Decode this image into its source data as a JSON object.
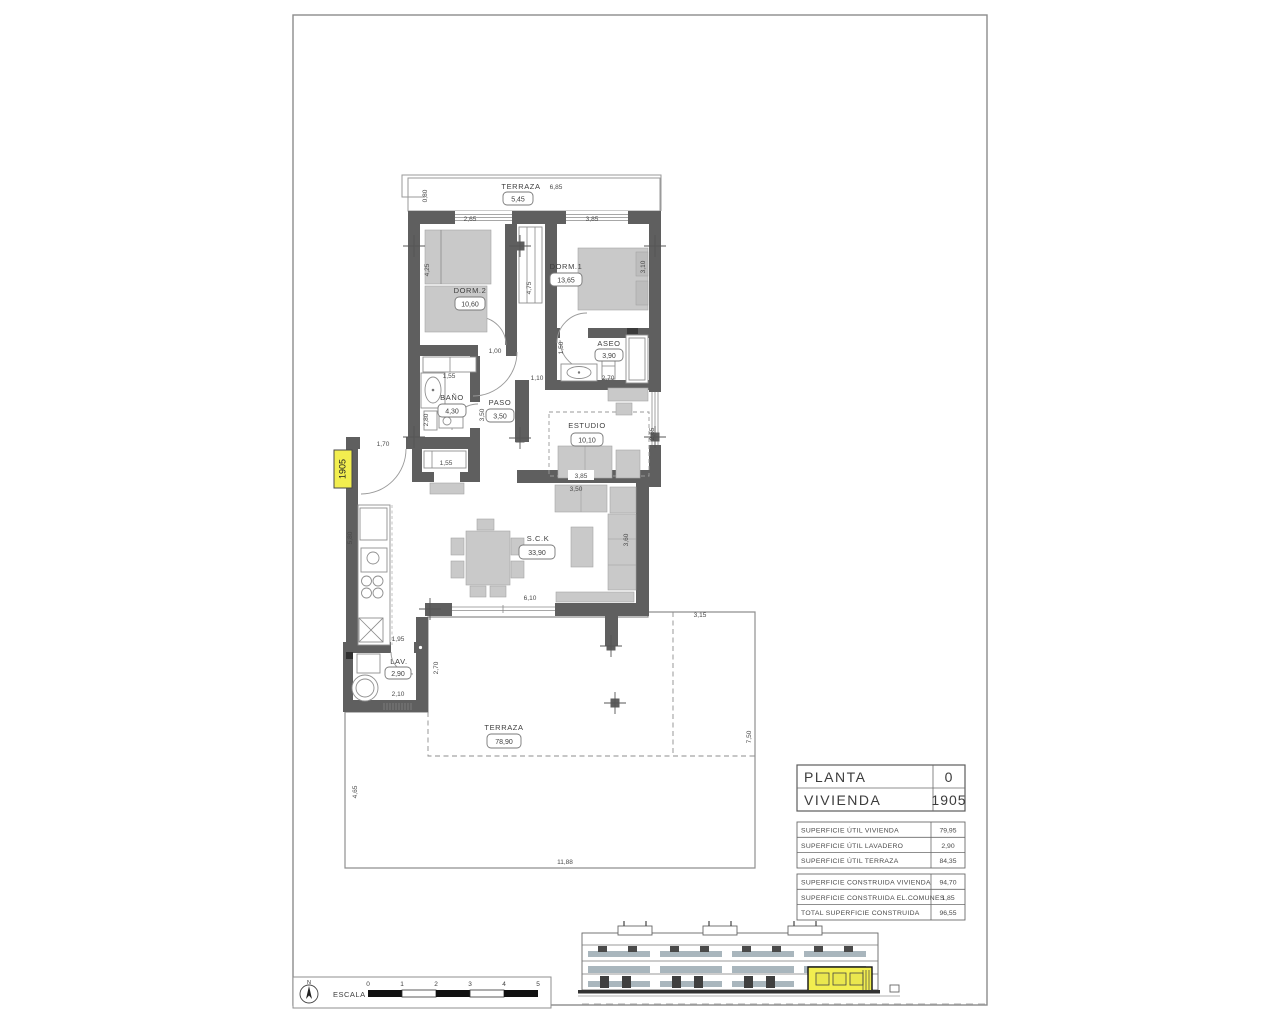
{
  "sheet": {
    "type": "floor-plan-drawing"
  },
  "unit_tag": "1905",
  "compass_n": "N",
  "rooms": {
    "terraza_top": {
      "name": "TERRAZA",
      "area": "5,45"
    },
    "dorm2": {
      "name": "DORM.2",
      "area": "10,60"
    },
    "dorm1": {
      "name": "DORM.1",
      "area": "13,65"
    },
    "aseo": {
      "name": "ASEO",
      "area": "3,90"
    },
    "bano": {
      "name": "BAÑO",
      "area": "4,30"
    },
    "paso": {
      "name": "PASO",
      "area": "3,50"
    },
    "estudio": {
      "name": "ESTUDIO",
      "area": "10,10"
    },
    "sck": {
      "name": "S.C.K",
      "area": "33,90"
    },
    "lav": {
      "name": "LAV.",
      "area": "2,90"
    },
    "terraza": {
      "name": "TERRAZA",
      "area": "78,90"
    }
  },
  "dims": {
    "top_terrace_len": "6,85",
    "top_terrace_depth": "0,80",
    "dorm2_width": "2,65",
    "dorm1_width": "3,85",
    "dorm2_height": "4,25",
    "hall_height": "4,75",
    "dorm1_height": "3,10",
    "bano_closet": "1,55",
    "paso_top": "1,00",
    "aseo_door": "1,50",
    "paso_right": "1,10",
    "aseo_depth": "2,70",
    "bano_depth": "2,80",
    "storage_width": "1,55",
    "estudio_width": "3,85",
    "estudio_sofa": "3,50",
    "estudio_height": "2,65",
    "entry_door": "1,70",
    "paso_height": "3,50",
    "kitchen_height": "5,80",
    "living_opening": "6,10",
    "living_height": "3,60",
    "lav_top": "1,95",
    "lav_width": "2,10",
    "lav_height": "2,70",
    "terrace_top": "3,15",
    "terrace_right": "7,50",
    "terrace_width": "11,88",
    "terrace_left": "4,65"
  },
  "title_block": {
    "planta_label": "PLANTA",
    "planta_value": "0",
    "vivienda_label": "VIVIENDA",
    "vivienda_value": "1905",
    "util": [
      {
        "label": "SUPERFICIE ÚTIL VIVIENDA",
        "value": "79,95"
      },
      {
        "label": "SUPERFICIE ÚTIL LAVADERO",
        "value": "2,90"
      },
      {
        "label": "SUPERFICIE ÚTIL TERRAZA",
        "value": "84,35"
      }
    ],
    "construida": [
      {
        "label": "SUPERFICIE CONSTRUIDA VIVIENDA",
        "value": "94,70"
      },
      {
        "label": "SUPERFICIE CONSTRUIDA EL.COMUNES",
        "value": "1,85"
      },
      {
        "label": "TOTAL SUPERFICIE CONSTRUIDA",
        "value": "96,55"
      }
    ]
  },
  "scale_bar": {
    "label": "ESCALA :",
    "ticks": [
      "0",
      "1",
      "2",
      "3",
      "4",
      "5"
    ]
  },
  "colors": {
    "wall": "#5f5f5f",
    "furniture": "#c9c9c9",
    "highlight_yellow": "#f2ee4f",
    "elevation_rail": "#a9b6bd",
    "hatch": "#cfcfcf"
  }
}
